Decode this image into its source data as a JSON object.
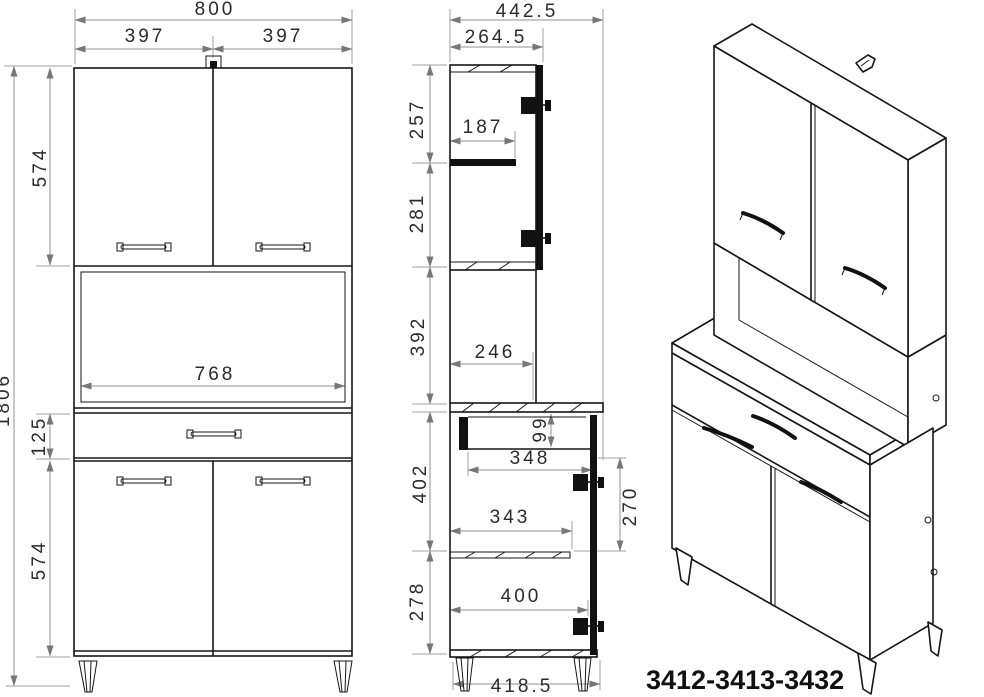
{
  "drawing": {
    "model_number": "3412-3413-3432",
    "colors": {
      "line": "#161616",
      "dimension_line": "#909090",
      "dimension_text": "#2b2b2b",
      "background": "#ffffff"
    },
    "views": {
      "front": "front-elevation",
      "side": "side-section",
      "perspective": "3d-perspective"
    },
    "dimension_labels": [
      {
        "label": "800",
        "view": "front",
        "x": 215,
        "y": 15,
        "rotated": false
      },
      {
        "label": "397",
        "view": "front",
        "x": 145,
        "y": 42,
        "rotated": false
      },
      {
        "label": "397",
        "view": "front",
        "x": 283,
        "y": 42,
        "rotated": false
      },
      {
        "label": "574",
        "view": "front",
        "x": 46,
        "y": 167,
        "rotated": true
      },
      {
        "label": "1806",
        "view": "front",
        "x": 9,
        "y": 400,
        "rotated": true
      },
      {
        "label": "768",
        "view": "front",
        "x": 215,
        "y": 380,
        "rotated": false
      },
      {
        "label": "125",
        "view": "front",
        "x": 45,
        "y": 436,
        "rotated": true
      },
      {
        "label": "574",
        "view": "front",
        "x": 45,
        "y": 560,
        "rotated": true
      },
      {
        "label": "442.5",
        "view": "side",
        "x": 527,
        "y": 17,
        "rotated": false
      },
      {
        "label": "264.5",
        "view": "side",
        "x": 496,
        "y": 43,
        "rotated": false
      },
      {
        "label": "257",
        "view": "side",
        "x": 423,
        "y": 119,
        "rotated": true
      },
      {
        "label": "187",
        "view": "side",
        "x": 483,
        "y": 133,
        "rotated": false
      },
      {
        "label": "281",
        "view": "side",
        "x": 423,
        "y": 213,
        "rotated": true
      },
      {
        "label": "392",
        "view": "side",
        "x": 424,
        "y": 336,
        "rotated": true
      },
      {
        "label": "246",
        "view": "side",
        "x": 495,
        "y": 358,
        "rotated": false
      },
      {
        "label": "402",
        "view": "side",
        "x": 426,
        "y": 483,
        "rotated": true
      },
      {
        "label": "99",
        "view": "side",
        "x": 546,
        "y": 429,
        "rotated": true
      },
      {
        "label": "348",
        "view": "side",
        "x": 530,
        "y": 464,
        "rotated": false
      },
      {
        "label": "270",
        "view": "side",
        "x": 636,
        "y": 506,
        "rotated": true
      },
      {
        "label": "343",
        "view": "side",
        "x": 510,
        "y": 523,
        "rotated": false
      },
      {
        "label": "278",
        "view": "side",
        "x": 423,
        "y": 601,
        "rotated": true
      },
      {
        "label": "400",
        "view": "side",
        "x": 521,
        "y": 602,
        "rotated": false
      },
      {
        "label": "418.5",
        "view": "side",
        "x": 522,
        "y": 692,
        "rotated": false
      }
    ]
  }
}
